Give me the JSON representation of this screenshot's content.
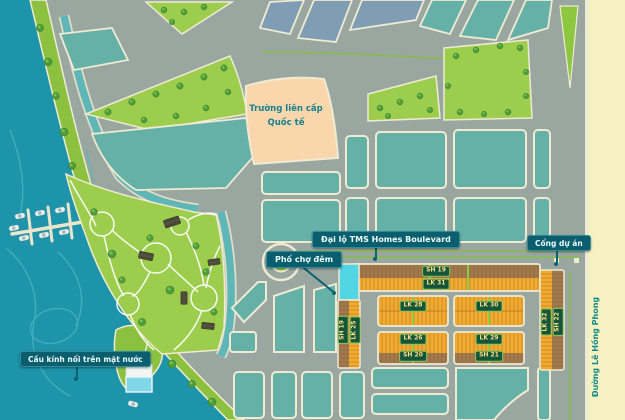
{
  "map": {
    "description": "Residential masterplan map with waterfront park, marina and shophouse plots",
    "landmarks": {
      "school_line1": "Trường liên cấp",
      "school_line2": "Quốc tế",
      "boulevard": "Đại lộ TMS Homes Boulevard",
      "night_market_street": "Phố chợ đêm",
      "project_gate": "Cổng dự án",
      "glass_bridge": "Cầu kính nối trên mặt nước",
      "right_street": "Đường Lê Hồng Phong"
    },
    "plots": {
      "top_strip_row1": "SH 19",
      "top_strip_row2": "LK 31",
      "left_strip_col1": "SH 19",
      "left_strip_col2": "LK 25",
      "right_strip_col1": "LK 32",
      "right_strip_col2": "SH 22",
      "row_a_left": "LK 28",
      "row_a_right": "LK 30",
      "row_b_left_main": "LK 26",
      "row_b_left_sub": "SH 20",
      "row_b_right_main": "LK 29",
      "row_b_right_sub": "SH 21"
    },
    "colors": {
      "water": "#1d94a9",
      "park_green": "#9ccd4c",
      "coast_green": "#8cc13f",
      "road_gray": "#9aa7a0",
      "road_edge_cream": "#efead2",
      "block_teal": "#66b1a7",
      "block_slate": "#7f9eb6",
      "school_peach": "#f9d6ab",
      "lot_orange": "#f0ab30",
      "lot_brown": "#a07a4e",
      "highlight_cyan": "#52d5e5",
      "label_teal_bg": "#0b5e6d",
      "plot_label_green": "#15563a",
      "median_green": "#86bd47",
      "right_road_yellow": "#f6f2c2"
    }
  }
}
